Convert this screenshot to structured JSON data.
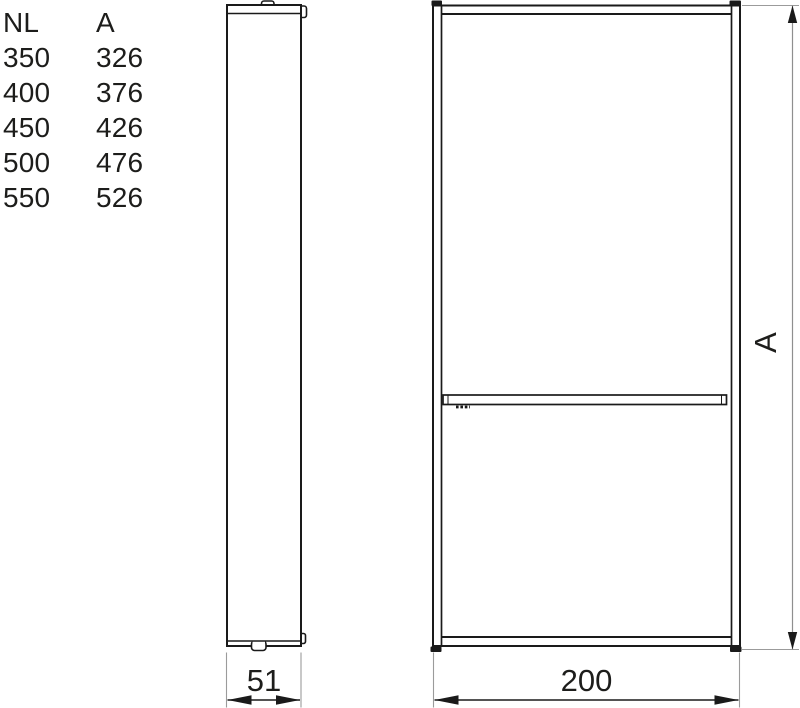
{
  "table": {
    "headers": [
      "NL",
      "A"
    ],
    "rows": [
      [
        "350",
        "326"
      ],
      [
        "400",
        "376"
      ],
      [
        "450",
        "426"
      ],
      [
        "500",
        "476"
      ],
      [
        "550",
        "526"
      ]
    ]
  },
  "dimensions": {
    "side_width": "51",
    "front_width": "200",
    "height_label": "A"
  },
  "colors": {
    "line": "#1a1a1a",
    "text": "#1d1d1b",
    "extension_line": "#9b9b9b",
    "height_dim_line": "#8f8f8f",
    "background": "#ffffff"
  }
}
